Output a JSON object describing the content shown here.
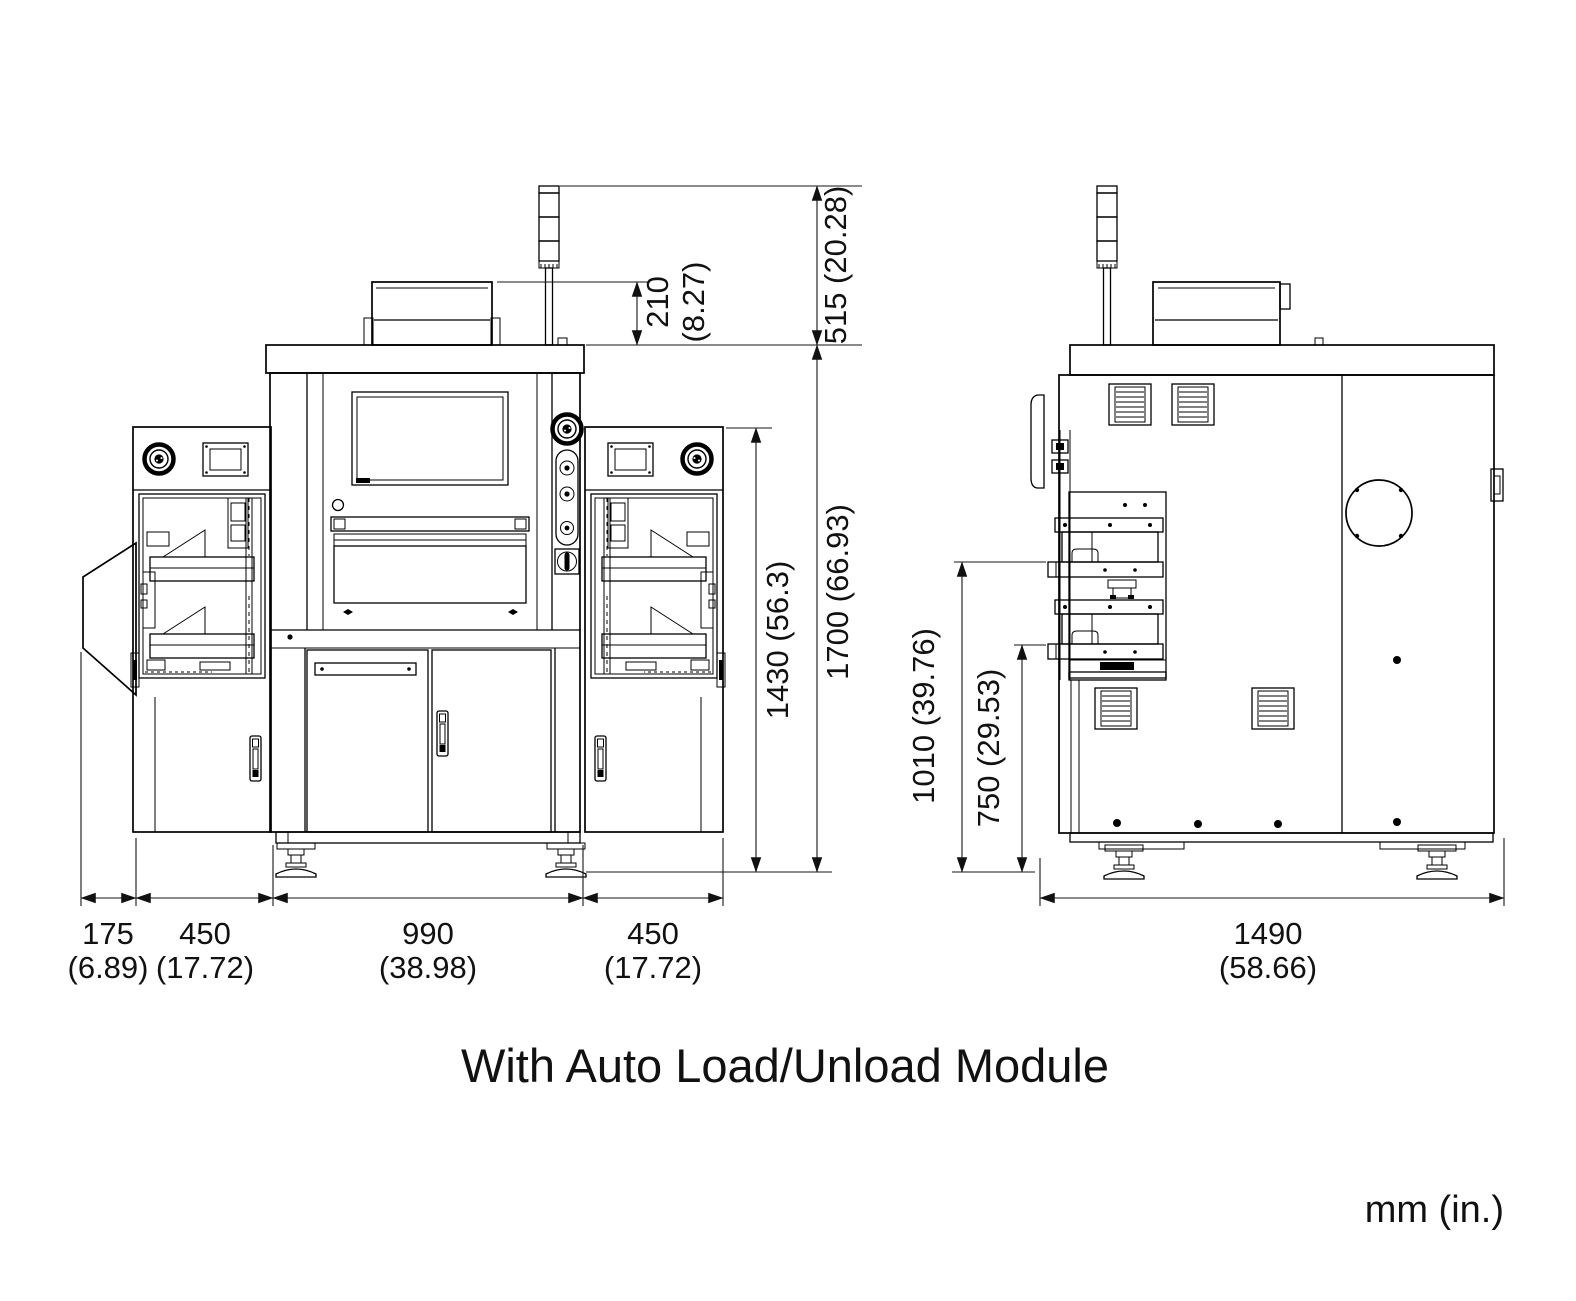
{
  "caption": "With Auto Load/Unload Module",
  "units_note": "mm (in.)",
  "front_view": {
    "dims": {
      "top_box_height_mm": "210",
      "top_box_height_in": "(8.27)",
      "tower_above_top": "515 (20.28)",
      "module_height": "1430 (56.3)",
      "overall_height": "1700 (66.93)",
      "overhang_mm": "175",
      "overhang_in": "(6.89)",
      "left_module_mm": "450",
      "left_module_in": "(17.72)",
      "center_body_mm": "990",
      "center_body_in": "(38.98)",
      "right_module_mm": "450",
      "right_module_in": "(17.72)"
    }
  },
  "side_view": {
    "dims": {
      "upper_shelf_height": "1010 (39.76)",
      "lower_shelf_height": "750 (29.53)",
      "depth_mm": "1490",
      "depth_in": "(58.66)"
    }
  }
}
